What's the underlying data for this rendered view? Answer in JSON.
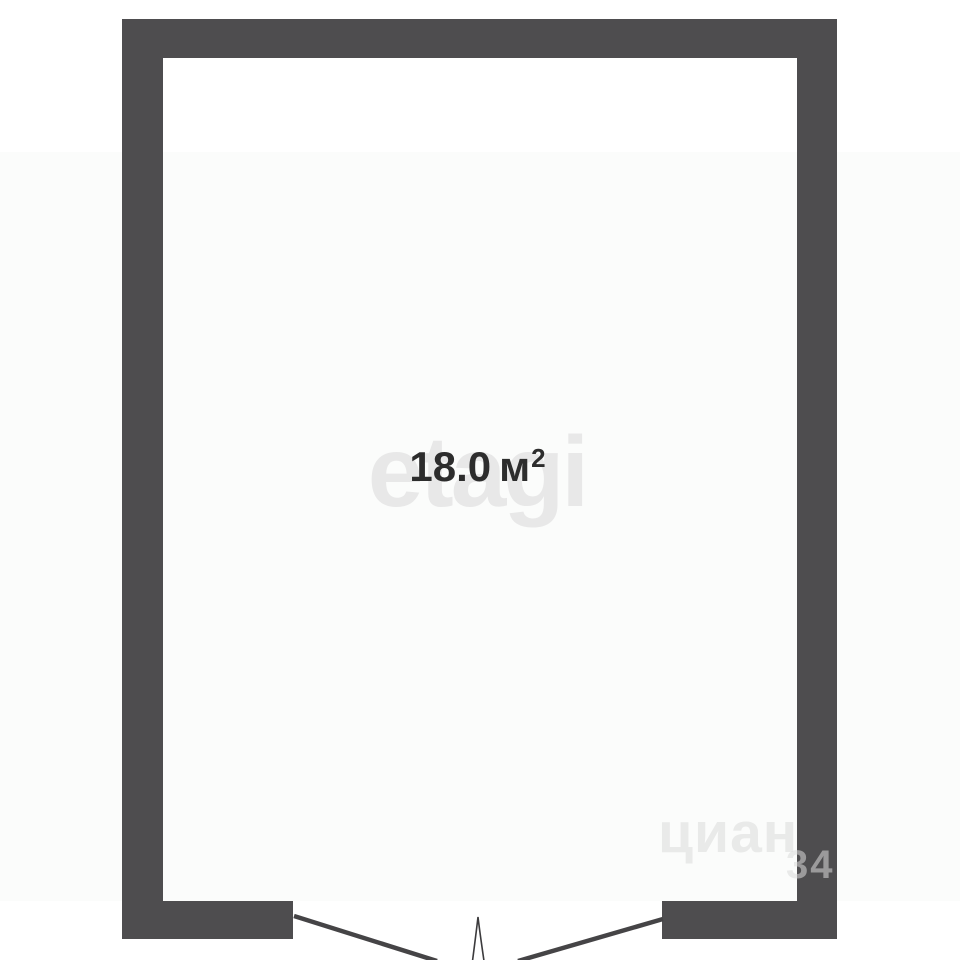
{
  "floorplan": {
    "room": {
      "area_value": "18.0",
      "area_unit": "м",
      "area_sup": "2"
    },
    "watermarks": {
      "center": "etagi",
      "corner_text": "циан",
      "corner_number": "34"
    },
    "colors": {
      "wall": "#4e4d4f",
      "door_line": "#454446",
      "background": "#ffffff",
      "area_text": "#2d2d2d",
      "watermark_center": "#e8e8e8",
      "watermark_corner": "#dadada"
    }
  }
}
